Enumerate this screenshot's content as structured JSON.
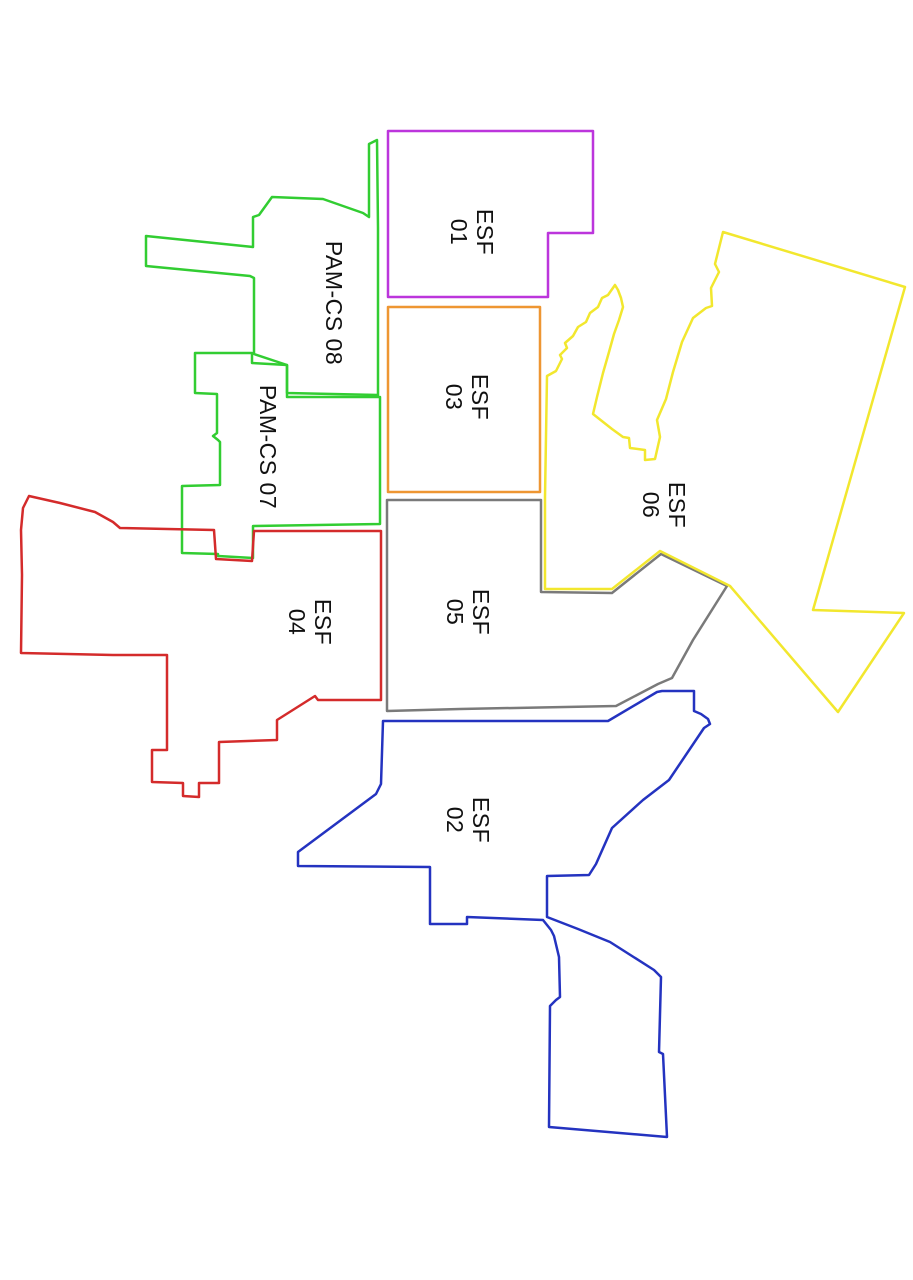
{
  "canvas": {
    "width": 913,
    "height": 1280,
    "background_color": "#ffffff",
    "stroke_width": 2.5,
    "label_color": "#111111"
  },
  "regions": [
    {
      "id": "esf-01",
      "label_lines": [
        "ESF",
        "01"
      ],
      "color": "#bc35dc",
      "label_x": 471,
      "label_y": 232,
      "points": "388,131 593,131 593,233 548,233 548,297 388,297"
    },
    {
      "id": "esf-03",
      "label_lines": [
        "ESF",
        "03"
      ],
      "color": "#ee9632",
      "label_x": 466,
      "label_y": 397,
      "points": "388,307 540,307 540,492 388,492"
    },
    {
      "id": "pam-cs-08",
      "label_lines": [
        "PAM-CS 08"
      ],
      "color": "#32cd32",
      "label_x": 333,
      "label_y": 303,
      "points": "259,215 272,197 323,199 363,213 369,217 369,144 377,140 378,228 378,395 287,393 287,365 254,354 254,278 250,276 146,266 146,236 253,247 253,217"
    },
    {
      "id": "pam-cs-07",
      "label_lines": [
        "PAM-CS 07"
      ],
      "color": "#32cd32",
      "label_x": 267,
      "label_y": 447,
      "points": "195,353 252,353 252,363 287,365 287,397 380,397 380,524 253,526 253,558 218,556 218,554 182,553 182,486 220,485 220,442 218,440 213,436 217,433 217,394 195,393"
    },
    {
      "id": "esf-04",
      "label_lines": [
        "ESF",
        "04"
      ],
      "color": "#d42b2b",
      "label_x": 309,
      "label_y": 622,
      "points": "29,496 60,503 95,512 113,522 120,528 214,530 216,559 252,561 254,531 381,531 381,700 318,700 315,696 277,720 277,740 219,742 219,783 199,783 199,797 183,796 183,783 152,782 152,750 167,750 167,655 113,655 21,653 22,575 21,530 23,508"
    },
    {
      "id": "esf-05",
      "label_lines": [
        "ESF",
        "05"
      ],
      "color": "#7a7a7a",
      "label_x": 467,
      "label_y": 612,
      "points": "387,500 541,500 541,592 612,593 661,554 727,586 693,640 672,678 658,684 616,706 460,709 387,711"
    },
    {
      "id": "esf-06",
      "label_lines": [
        "ESF",
        "06"
      ],
      "color": "#f2e72e",
      "label_x": 663,
      "label_y": 505,
      "points": "723,232 905,287 813,610 904,613 838,712 730,586 660,551 612,589 545,589 545,497 547,376 556,371 562,359 560,355 567,348 565,343 573,336 578,327 586,322 590,313 598,307 602,298 608,295 615,285 618,290 621,298 623,307 619,320 614,334 609,352 603,373 597,397 593,414 612,429 623,437 629,438 630,448 645,450 645,460 655,459 660,437 657,420 666,399 673,372 682,342 693,318 706,308 712,306 711,288 719,272 715,264"
    },
    {
      "id": "esf-02",
      "label_lines": [
        "ESF",
        "02"
      ],
      "color": "#2433c0",
      "label_x": 467,
      "label_y": 820,
      "points": "383,721 608,721 657,692 662,691 694,691 694,711 701,714 708,719 710,724 704,728 669,780 643,800 612,828 596,864 589,875 547,876 547,917 578,929 610,942 654,970 661,977 659,1052 663,1054 667,1137 549,1127 550,1006 556,1000 560,997 559,957 554,936 551,930 543,920 467,917 467,924 430,924 430,867 298,866 298,852 376,794 381,784"
    }
  ]
}
